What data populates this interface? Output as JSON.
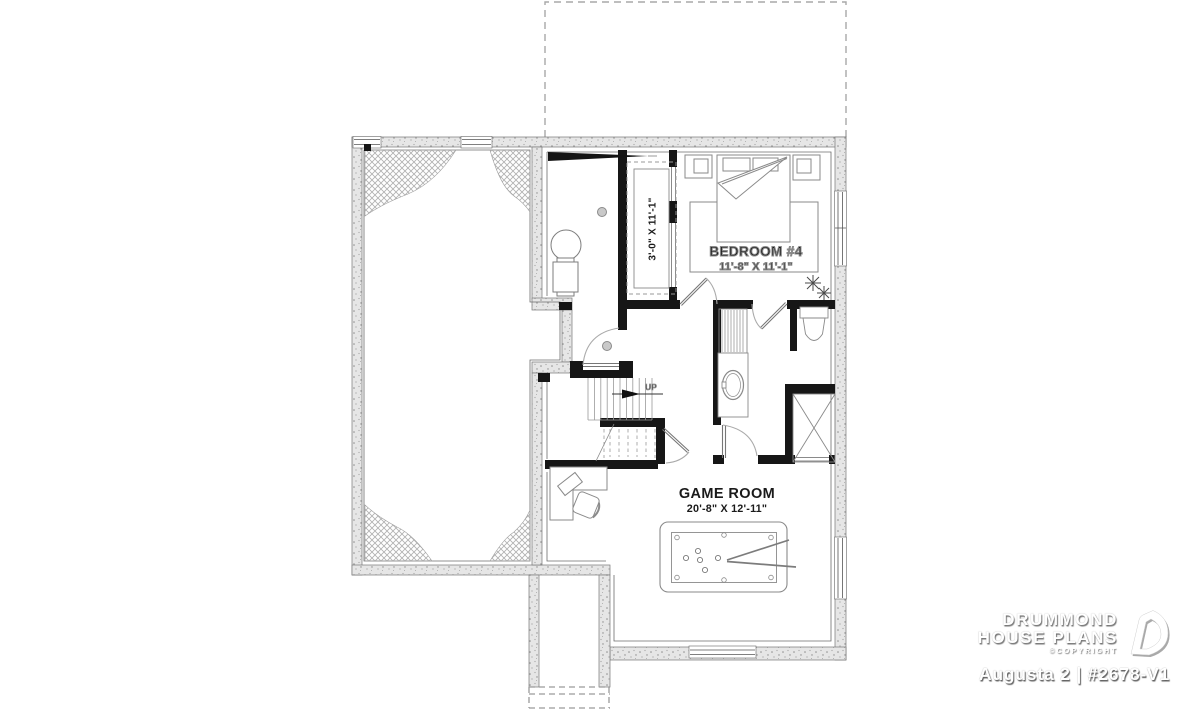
{
  "rooms": {
    "bedroom": {
      "name": "BEDROOM #4",
      "dims": "11'-8\" X 11'-1\""
    },
    "game_room": {
      "name": "GAME ROOM",
      "dims": "20'-8\" X 12'-11\""
    },
    "closet": {
      "dims": "3'-0\" X 11'-1\""
    }
  },
  "stairs": {
    "direction_label": "UP"
  },
  "branding": {
    "name_line1": "DRUMMOND",
    "name_line2": "HOUSE PLANS",
    "copyright": "©COPYRIGHT",
    "plan_title": "Augusta 2 | #2678-V1"
  },
  "colors": {
    "background": "#ffffff",
    "wall_fill": "#e6e6e6",
    "wall_edge": "#777777",
    "interior_wall": "#161616",
    "furniture_line": "#888888",
    "dashed_line": "#9a9a9a",
    "label_text": "#1a1a1a",
    "logo_text": "#ffffff"
  }
}
